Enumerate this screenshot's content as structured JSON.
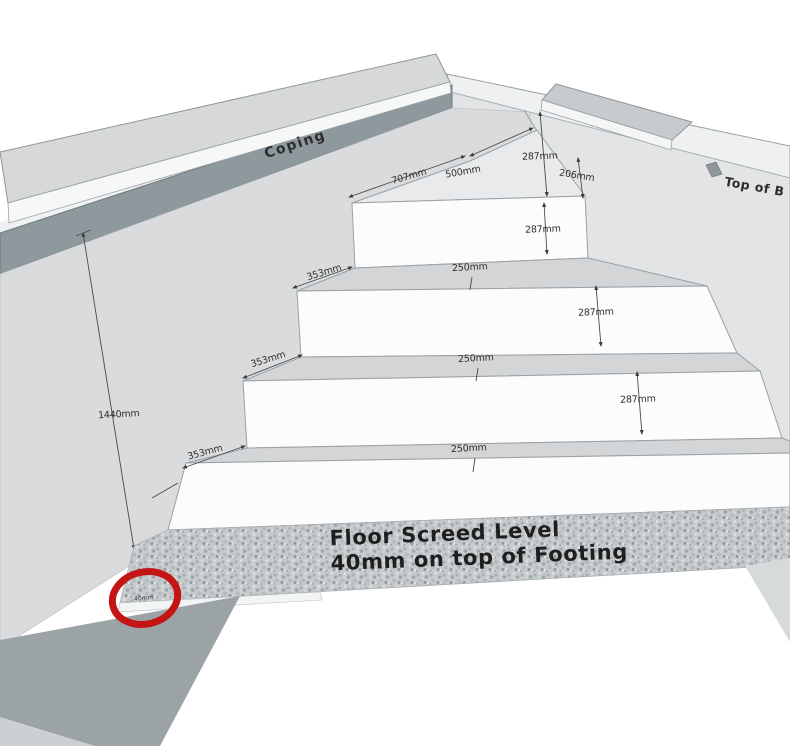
{
  "diagram": {
    "type": "3d-construction-sketch",
    "subject": "corner-steps-with-coping-and-floor-screed",
    "labels": {
      "coping": "Coping",
      "wall_top": "Top of B",
      "floor_line1": "Floor Screed Level",
      "floor_line2": "40mm on top of Footing",
      "circle_note": "40mm"
    },
    "dims": [
      {
        "id": "height-above-top-step",
        "label": "287mm"
      },
      {
        "id": "top-tread-left-edge",
        "label": "707mm"
      },
      {
        "id": "top-tread-right-edge",
        "label": "500mm"
      },
      {
        "id": "wall-top-offset",
        "label": "206mm"
      },
      {
        "id": "riser-4",
        "label": "287mm"
      },
      {
        "id": "tread-3-side",
        "label": "353mm"
      },
      {
        "id": "tread-3-width",
        "label": "250mm"
      },
      {
        "id": "riser-3",
        "label": "287mm"
      },
      {
        "id": "tread-2-side",
        "label": "353mm"
      },
      {
        "id": "tread-2-width",
        "label": "250mm"
      },
      {
        "id": "riser-2",
        "label": "287mm"
      },
      {
        "id": "tread-1-side",
        "label": "353mm"
      },
      {
        "id": "tread-1-width",
        "label": "250mm"
      },
      {
        "id": "wall-height",
        "label": "1440mm"
      }
    ],
    "colors": {
      "highlight_red": "#c41414",
      "wall_gray": "#d9dbdd",
      "wall_gray_right": "#e2e4e5",
      "band_slate": "#8e999e",
      "screed_gray": "#c7cbcd",
      "dim_line": "#4a4a4a"
    }
  }
}
